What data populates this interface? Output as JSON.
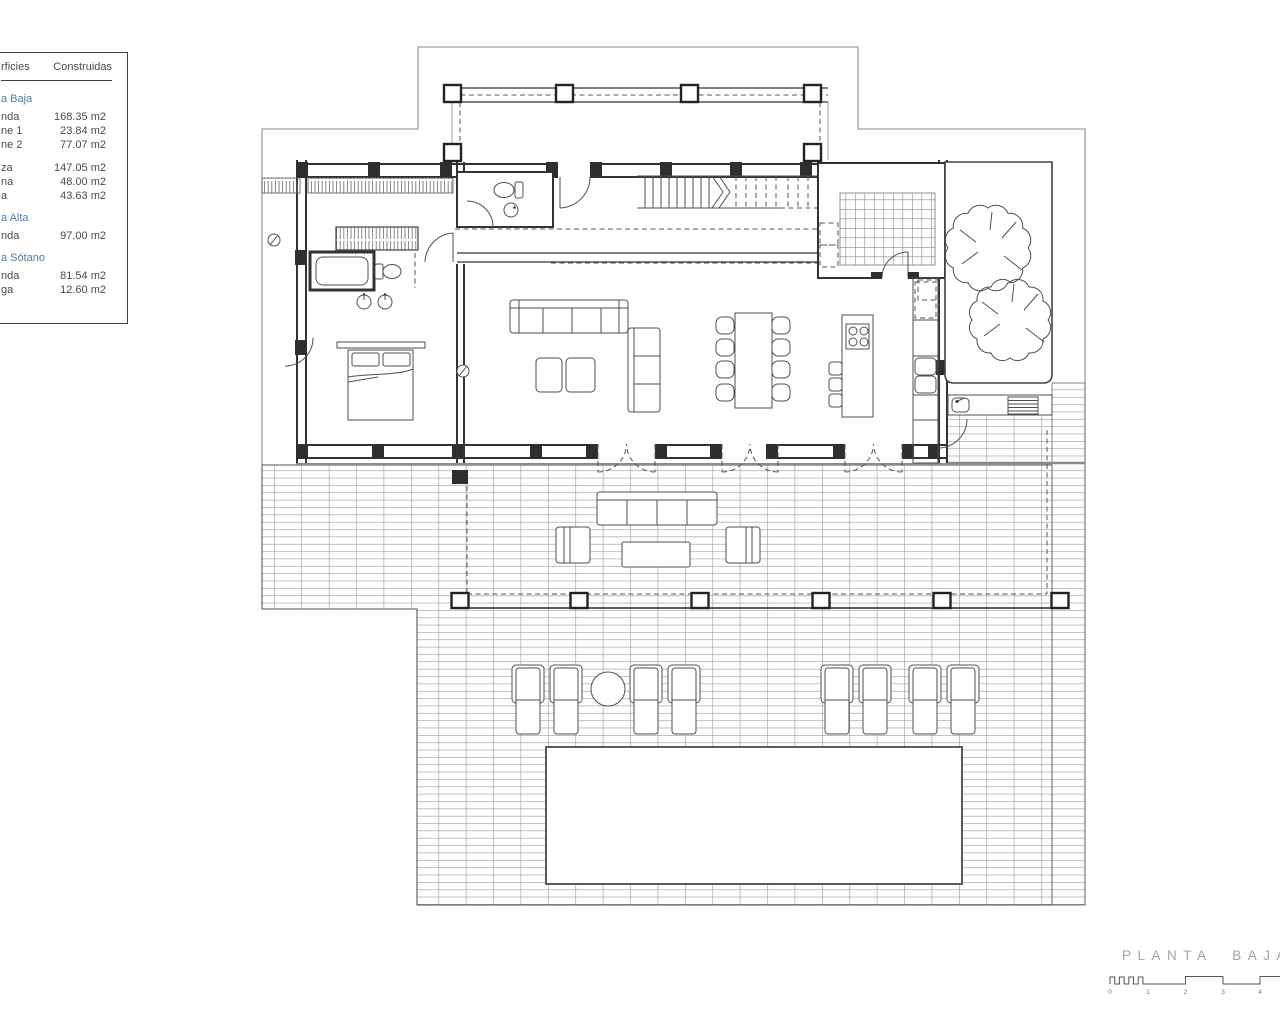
{
  "document": {
    "background": "#ffffff",
    "accent_blue": "#4e7ca8",
    "line_color": "#333333"
  },
  "surface_table": {
    "header": {
      "left_fragment": "rficies",
      "right": "Construidas"
    },
    "sections": [
      {
        "title_fragment": "a Baja",
        "rows": [
          {
            "label_fragment": "nda",
            "value": "168.35 m2"
          },
          {
            "label_fragment": "ne 1",
            "value": "23.84 m2"
          },
          {
            "label_fragment": "ne 2",
            "value": "77.07 m2"
          },
          {
            "label_fragment": "za",
            "value": "147.05 m2"
          },
          {
            "label_fragment": "na",
            "value": "48.00 m2"
          },
          {
            "label_fragment": "a",
            "value": "43.63 m2"
          }
        ]
      },
      {
        "title_fragment": "a Alta",
        "rows": [
          {
            "label_fragment": "nda",
            "value": "97.00 m2"
          }
        ]
      },
      {
        "title_fragment": "a Sótano",
        "rows": [
          {
            "label_fragment": "nda",
            "value": "81.54 m2"
          },
          {
            "label_fragment": "ga",
            "value": "12.60 m2"
          }
        ]
      }
    ]
  },
  "plan": {
    "title": "PLANTA  BAJA",
    "scale_bar": {
      "ticks": [
        "0",
        "1",
        "2",
        "3",
        "4"
      ]
    },
    "rooms": [
      "covered-porch",
      "entrance-hall",
      "guest-wc",
      "staircase",
      "laundry-room",
      "courtyard-with-trees",
      "kitchen",
      "living-dining-room",
      "master-bedroom",
      "ensuite-bathroom",
      "covered-terrace",
      "pool-terrace"
    ],
    "furniture": [
      "sofa",
      "ottomans",
      "chaise-sofa",
      "dining-table-8-chairs",
      "kitchen-island-hob-stools",
      "double-bed",
      "wardrobe",
      "bathtub",
      "outdoor-sofa-set",
      "sun-loungers-x8",
      "round-side-table",
      "swimming-pool",
      "outdoor-sink-counter",
      "fridge",
      "trees-x2"
    ]
  }
}
